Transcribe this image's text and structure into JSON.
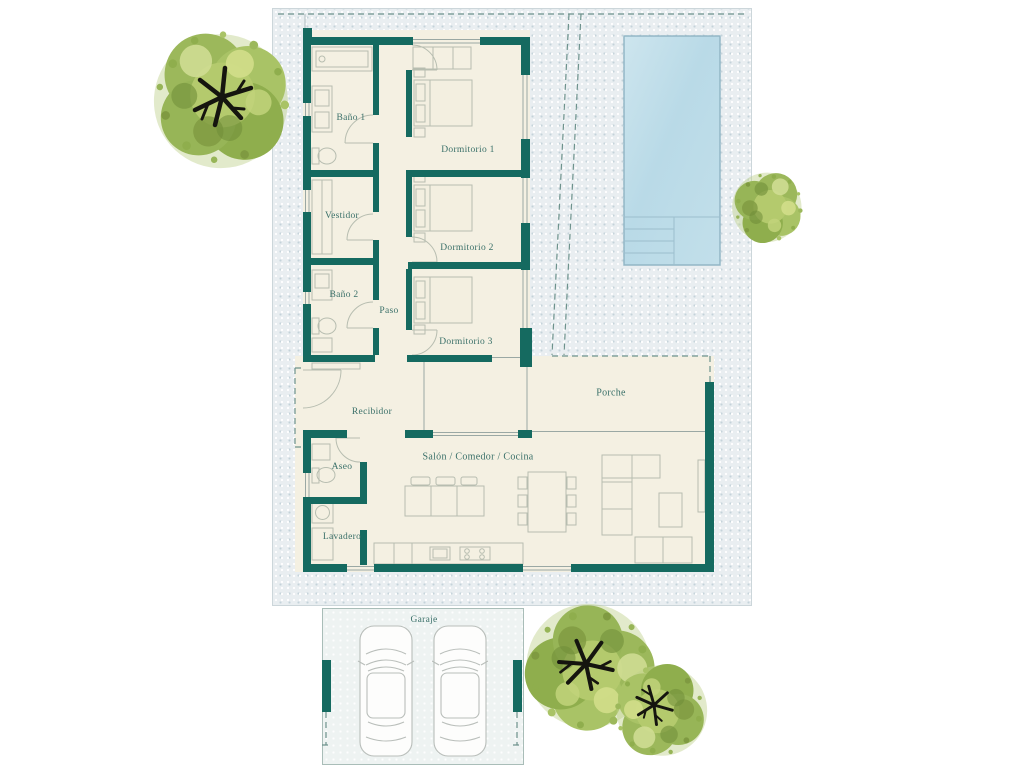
{
  "floor_plan": {
    "rooms": [
      {
        "name": "Baño 1"
      },
      {
        "name": "Dormitorio 1"
      },
      {
        "name": "Vestidor"
      },
      {
        "name": "Dormitorio 2"
      },
      {
        "name": "Baño 2"
      },
      {
        "name": "Paso"
      },
      {
        "name": "Dormitorio 3"
      },
      {
        "name": "Recibidor"
      },
      {
        "name": "Porche"
      },
      {
        "name": "Aseo"
      },
      {
        "name": "Salón / Comedor / Cocina"
      },
      {
        "name": "Lavadero"
      },
      {
        "name": "Garaje"
      }
    ],
    "colors": {
      "wall": "#156a60",
      "floor": "#f4f0e2",
      "plot_background": "#e9eef1",
      "pool_water": "#bedde9",
      "label_text": "#3a7069",
      "furniture_line": "#b7bdb0",
      "tree_foliage": "#9cb85b"
    }
  }
}
